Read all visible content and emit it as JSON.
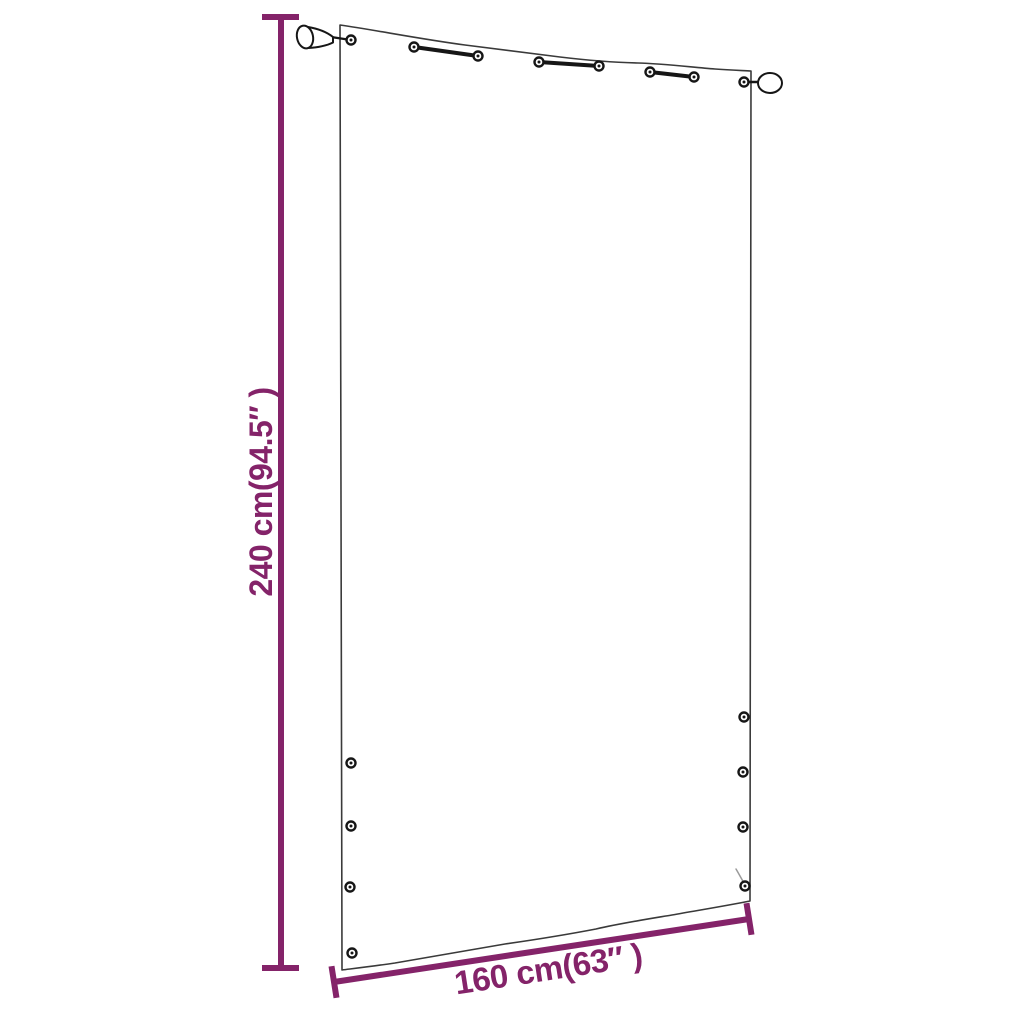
{
  "diagram": {
    "product": "balcony-screen-panel",
    "height_label": "240 cm(94.5″ )",
    "width_label": "160 cm(63″ )"
  },
  "colors": {
    "dimension": "#842369",
    "outline": "#3a3a3a",
    "hardware": "#161616",
    "background": "#ffffff"
  }
}
